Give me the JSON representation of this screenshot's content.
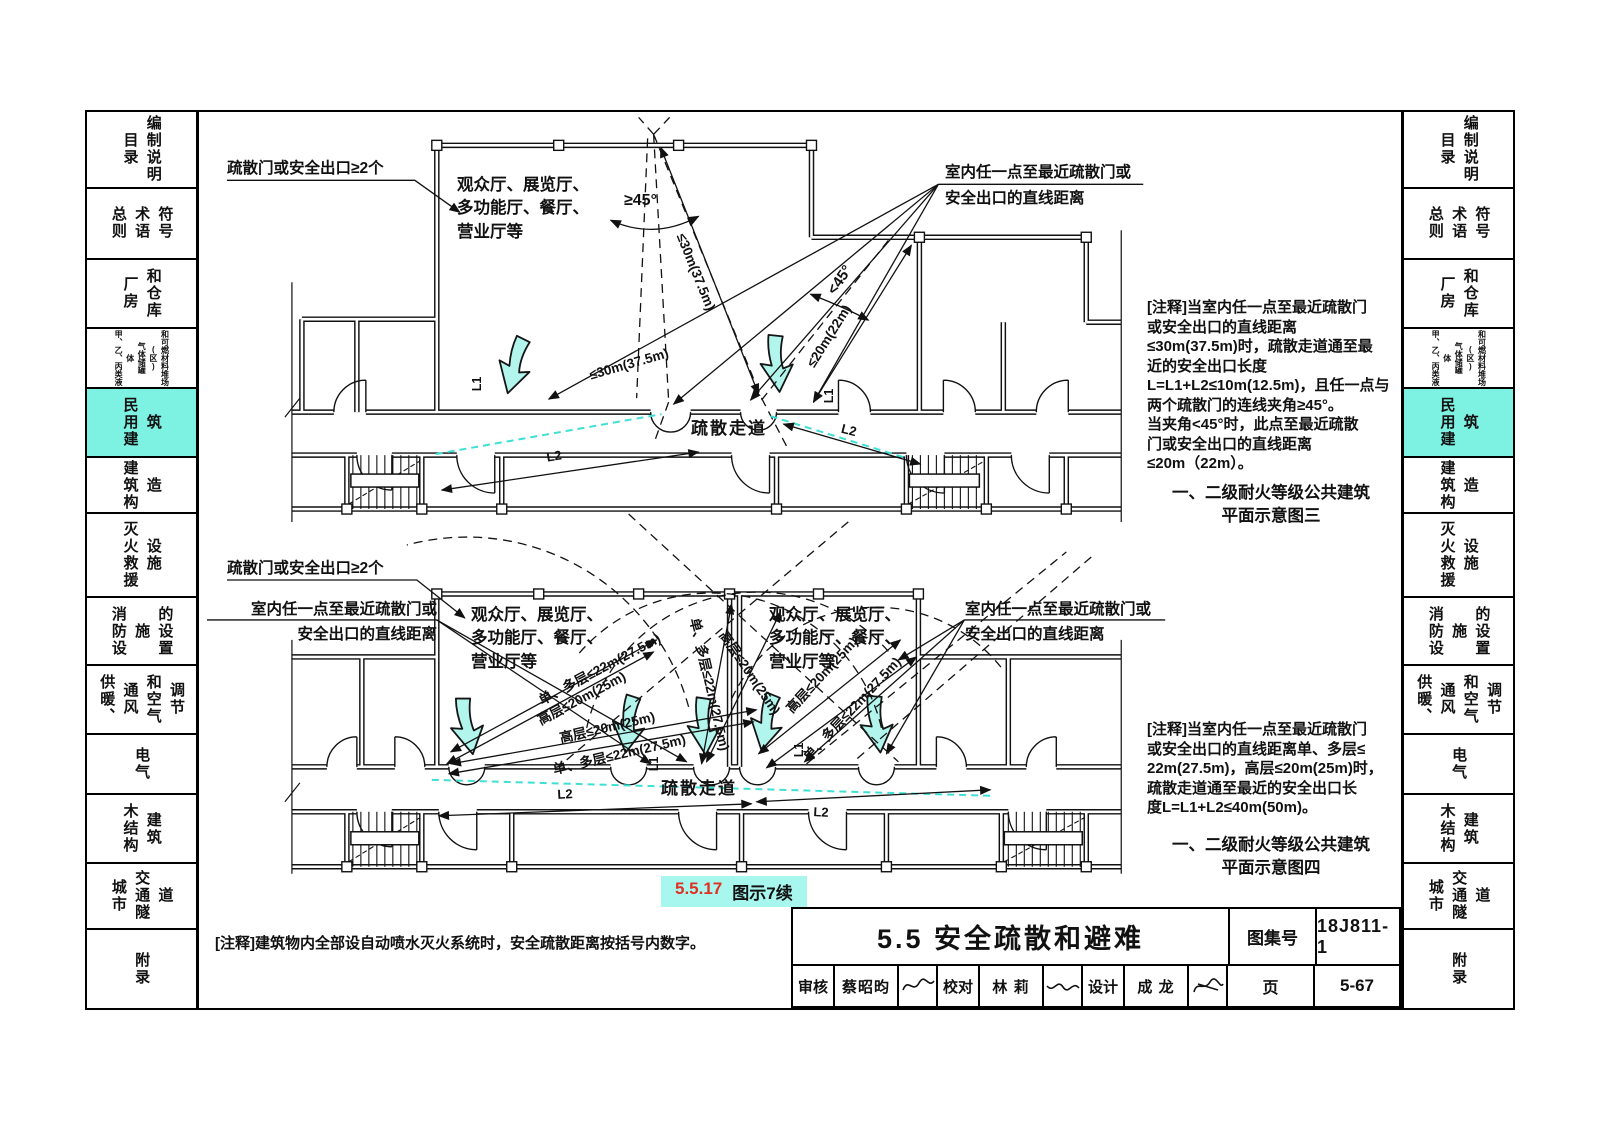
{
  "theme": {
    "accent_cyan": "#7df2e2",
    "caption_bg": "#a7f7ef",
    "red": "#e03024",
    "line": "#111111",
    "cyan_dash": "#3fe0d4",
    "arrow_fill": "#b2f5ec"
  },
  "sidebar": {
    "tabs": [
      {
        "label": "目录\n编制说明",
        "active": false,
        "small": false
      },
      {
        "label": "总则\n术语\n符号",
        "active": false,
        "small": false
      },
      {
        "label": "厂房\n和仓库",
        "active": false,
        "small": false
      },
      {
        "label": "甲、乙、丙类液体\n气体储罐(区)\n和可燃材料堆场",
        "active": false,
        "small": true
      },
      {
        "label": "民用建筑",
        "active": true,
        "small": false
      },
      {
        "label": "建筑构造",
        "active": false,
        "small": false
      },
      {
        "label": "灭火救援\n设施",
        "active": false,
        "small": false
      },
      {
        "label": "消防设施\n的设置",
        "active": false,
        "small": false
      },
      {
        "label": "供暖、通风\n和空气调节",
        "active": false,
        "small": false
      },
      {
        "label": "电气",
        "active": false,
        "small": false
      },
      {
        "label": "木结构\n建筑",
        "active": false,
        "small": false
      },
      {
        "label": "城市\n交通隧道",
        "active": false,
        "small": false
      },
      {
        "label": "附录",
        "active": false,
        "small": false
      }
    ]
  },
  "top": {
    "exit_label": "疏散门或安全出口≥2个",
    "room_label": "观众厅、展览厅、\n多功能厅、餐厅、\n营业厅等",
    "dist_l1": "室内任一点至最近疏散门或",
    "dist_l2": "安全出口的直线距离",
    "angle_ge": "≥45°",
    "angle_lt": "<45°",
    "d30_a": "≤30m(37.5m)",
    "d30_b": "≤30m(37.5m)",
    "d20": "≤20m(22m)",
    "corridor": "疏散走道",
    "L1": "L1",
    "L2": "L2"
  },
  "bottom": {
    "exit_label": "疏散门或安全出口≥2个",
    "dist_left_l1": "室内任一点至最近疏散门或",
    "dist_left_l2": "安全出口的直线距离",
    "dist_right_l1": "室内任一点至最近疏散门或",
    "dist_right_l2": "安全出口的直线距离",
    "room_left": "观众厅、展览厅、\n多功能厅、餐厅、\n营业厅等",
    "room_right": "观众厅、展览厅、\n多功能厅、餐厅、\n营业厅等",
    "dim_a": "单、多层≤22m(27.5m)",
    "dim_b": "高层≤20m(25m)",
    "dim_c": "高层≤20m(25m)",
    "dim_d": "单、多层≤22m(27.5m)",
    "dim_e": "单、多层≤22m(27.5m)",
    "dim_f": "高层≤20m(25m)",
    "dim_g": "高层≤20m(25m)",
    "dim_h": "单、多层≤22m(27.5m)",
    "corridor": "疏散走道",
    "L1": "L1",
    "L2": "L2",
    "caption_no": "5.5.17",
    "caption_text": "图示7续"
  },
  "notes": {
    "note3": "[注释]当室内任一点至最近疏散门\n或安全出口的直线距离\n≤30m(37.5m)时，疏散走道通至最\n近的安全出口长度\nL=L1+L2≤10m(12.5m)，且任一点与\n两个疏散门的连线夹角≥45°。\n当夹角<45°时，此点至最近疏散\n门或安全出口的直线距离\n≤20m（22m）。",
    "cap3a": "一、二级耐火等级公共建筑",
    "cap3b": "平面示意图三",
    "note4": "[注释]当室内任一点至最近疏散门\n或安全出口的直线距离单、多层≤\n22m(27.5m)，高层≤20m(25m)时，\n疏散走道通至最近的安全出口长\n度L=L1+L2≤40m(50m)。",
    "cap4a": "一、二级耐火等级公共建筑",
    "cap4b": "平面示意图四",
    "foot": "[注释]建筑物内全部设自动喷水灭火系统时，安全疏散距离按括号内数字。"
  },
  "titleblock": {
    "title": "5.5 安全疏散和避难",
    "atlas_label": "图集号",
    "atlas_no": "18J811-1",
    "page_label": "页",
    "page_no": "5-67",
    "cells": [
      {
        "label": "审核",
        "name": "蔡昭昀"
      },
      {
        "label": "校对",
        "name": "林 莉"
      },
      {
        "label": "设计",
        "name": "成 龙"
      }
    ]
  }
}
